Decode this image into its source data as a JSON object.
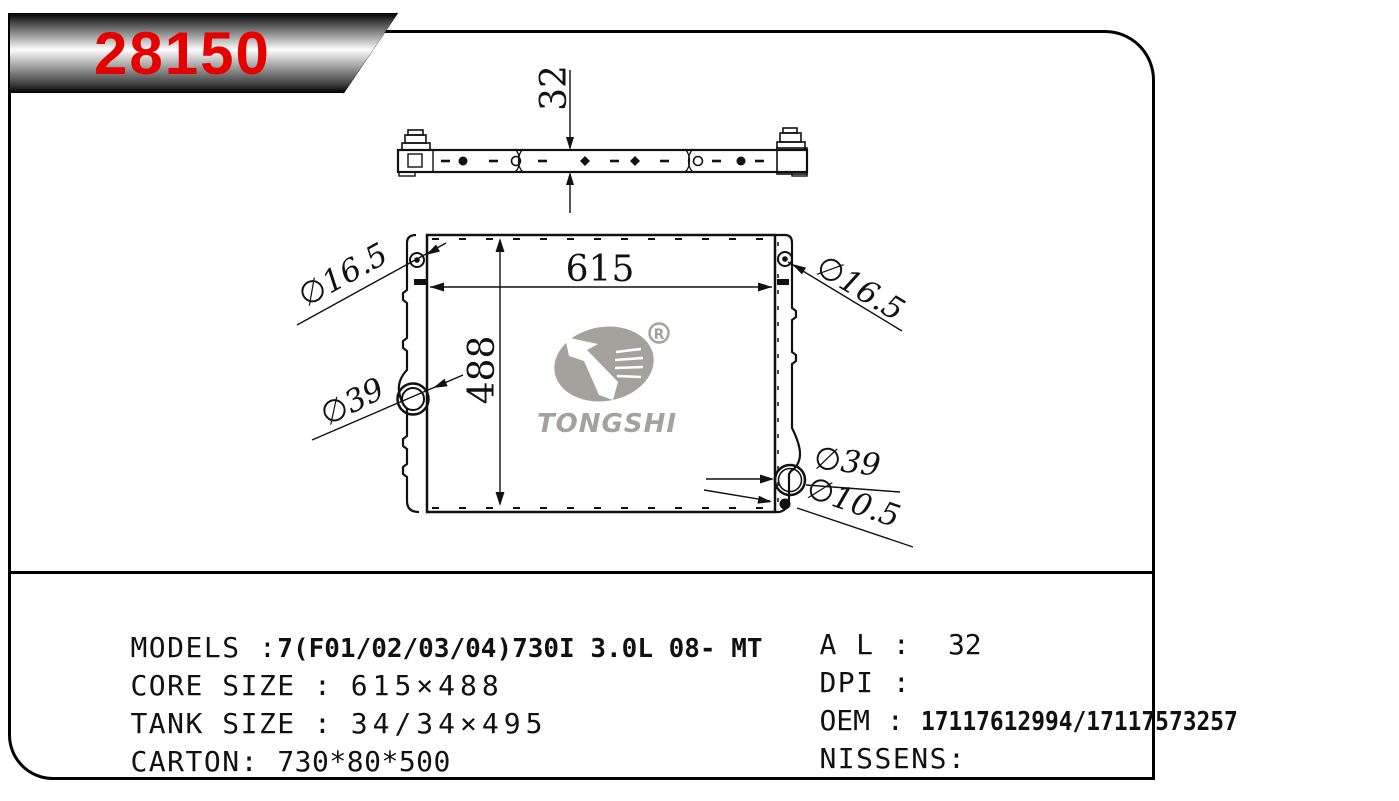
{
  "part_number": "28150",
  "logo": {
    "brand": "TONGSHI",
    "registered": "R"
  },
  "colors": {
    "accent_red": "#e60000",
    "logo_gray": "#a5a29d",
    "line_black": "#111111"
  },
  "drawing": {
    "dim_top_thickness": "32",
    "dim_core_width": "615",
    "dim_core_height": "488",
    "dia_hole_top_left": "∅16.5",
    "dia_hole_top_right": "∅16.5",
    "dia_port_left": "∅39",
    "dia_port_bottom_right": "∅39",
    "dia_hole_bottom_right": "∅10.5"
  },
  "specs": {
    "models_label": "MODELS :",
    "models_value": "7(F01/02/03/04)730I 3.0L 08- MT",
    "core_label": "CORE SIZE :",
    "core_value": "615×488",
    "tank_label": "TANK SIZE :",
    "tank_value": "34/34×495",
    "carton_label": "CARTON:",
    "carton_value": "730*80*500",
    "al_label": "A L :",
    "al_value": "32",
    "dpi_label": "DPI :",
    "dpi_value": "",
    "oem_label": "OEM :",
    "oem_value": "17117612994/17117573257",
    "nissens_label": "NISSENS:",
    "nissens_value": ""
  }
}
